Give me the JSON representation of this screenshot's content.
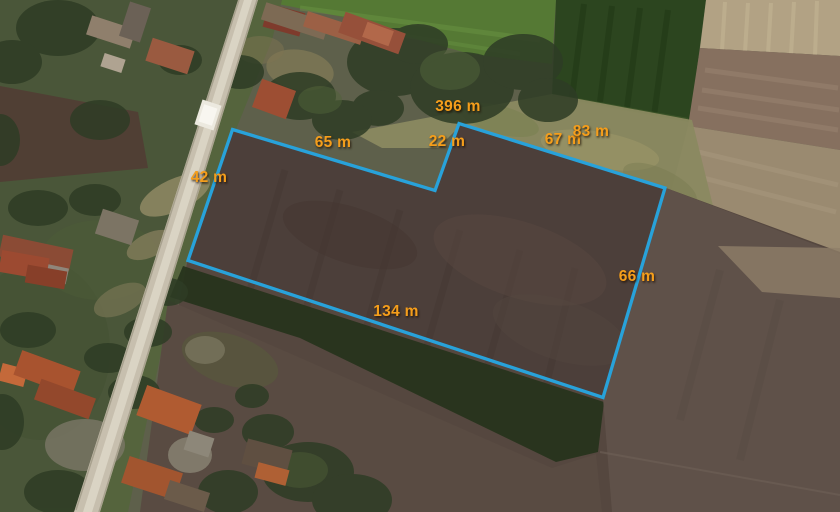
{
  "map": {
    "view": "satellite",
    "overlay": {
      "line_color": "#28A2DA",
      "label_color": "#F59E1B",
      "unit": "m",
      "total": {
        "label": "396 m",
        "value": 396
      },
      "segments": [
        {
          "side": "west",
          "label": "42 m",
          "value": 42
        },
        {
          "side": "north-west",
          "label": "65 m",
          "value": 65
        },
        {
          "side": "notch",
          "label": "22 m",
          "value": 22
        },
        {
          "side": "north",
          "label": "67 m",
          "value": 67
        },
        {
          "side": "north-2",
          "label": "83 m",
          "value": 83
        },
        {
          "side": "east",
          "label": "66 m",
          "value": 66
        },
        {
          "side": "south",
          "label": "134 m",
          "value": 134
        }
      ]
    }
  }
}
